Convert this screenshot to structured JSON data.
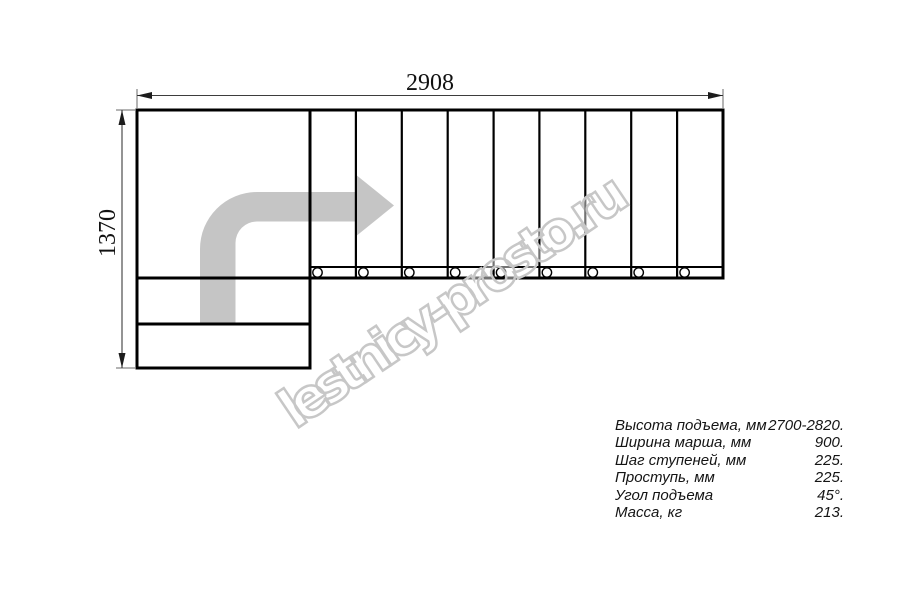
{
  "page": {
    "background": "#ffffff"
  },
  "drawing": {
    "width_label": "2908",
    "height_label": "1370",
    "tread_count": 9,
    "lower_step_count": 2
  },
  "watermark": {
    "text": "lestnicy-prosto.ru"
  },
  "specs": {
    "rows": [
      {
        "label": "Высота подъема, мм",
        "value": "2700-2820."
      },
      {
        "label": "Ширина марша, мм",
        "value": "900."
      },
      {
        "label": "Шаг ступеней, мм",
        "value": "225."
      },
      {
        "label": "Проступь, мм",
        "value": "225."
      },
      {
        "label": "Угол подъема",
        "value": "45°."
      },
      {
        "label": "Масса, кг",
        "value": "213."
      }
    ]
  },
  "colors": {
    "line": "#000000",
    "dimension": "#3d3d3d",
    "arrow_fill": "#c5c5c5",
    "watermark_stroke": "#c7c7c7"
  }
}
